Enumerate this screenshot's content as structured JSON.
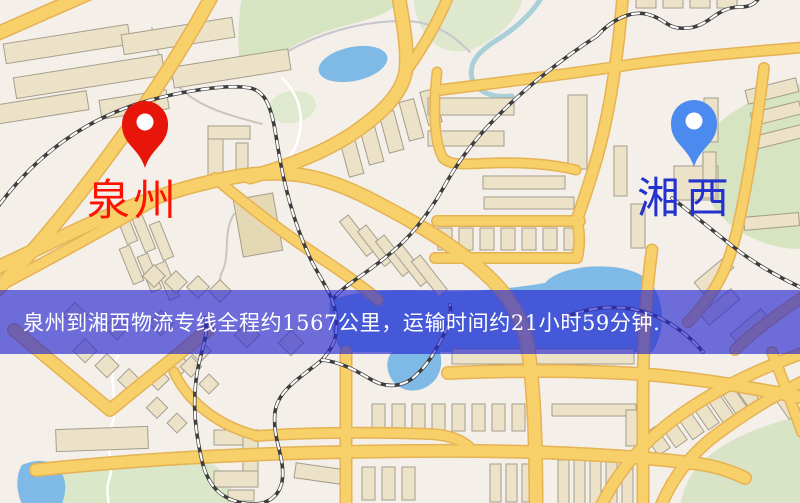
{
  "banner": {
    "text": "泉州到湘西物流专线全程约1567公里，运输时间约21小时59分钟.",
    "background": "rgba(40,40,210,0.66)",
    "text_color": "#ffffff"
  },
  "route": {
    "origin": "泉州",
    "destination": "湘西",
    "distance_text": "约1567公里",
    "duration_text": "约21小时59分钟"
  },
  "markers": {
    "origin": {
      "label": "泉州",
      "icon": "map-pin",
      "pin_color": "#e8150b",
      "label_color": "#fe1200"
    },
    "destination": {
      "label": "湘西",
      "icon": "map-pin",
      "pin_color": "#4b8bf0",
      "label_color": "#2331cd"
    }
  },
  "map": {
    "colors": {
      "background": "#f4efe8",
      "road": "#f8d06a",
      "road_casing": "#e5b254",
      "building": "#ece2c8",
      "building_outline": "#a59e8d",
      "park": "#d7e4c2",
      "water": "#7fb9e5",
      "railway": "#3e3e3e"
    }
  }
}
